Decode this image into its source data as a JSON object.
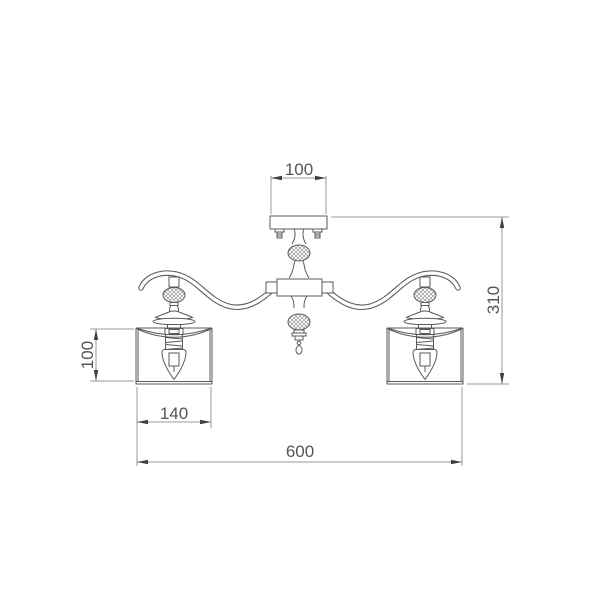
{
  "drawing": {
    "subject": "two-arm ceiling chandelier with cylindrical shades, dimensional line drawing",
    "background_color": "#ffffff",
    "line_color": "#5a5a5a",
    "dimension_line_color": "#9a9a9a",
    "text_color": "#555555",
    "dimensions": {
      "canopy_width": "100",
      "shade_height": "100",
      "shade_diameter": "140",
      "fixture_height": "310",
      "fixture_width": "600"
    }
  }
}
